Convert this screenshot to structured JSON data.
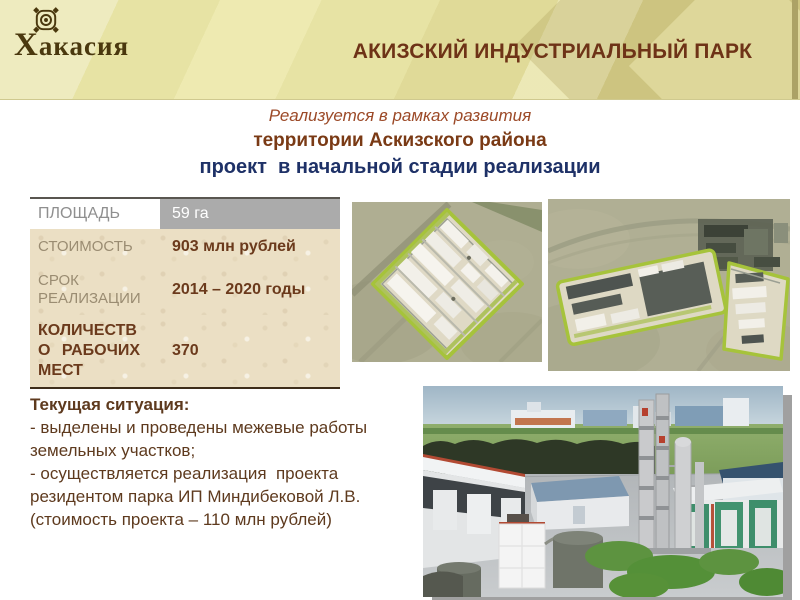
{
  "logo": {
    "region_name": "Хакасия"
  },
  "header": {
    "title": "АКИЗСКИЙ ИНДУСТРИАЛЬНЫЙ ПАРК"
  },
  "subtitle": {
    "line1": "Реализуется в рамках развития",
    "line2": "территории Аскизского района",
    "line3": "проект  в начальной стадии реализации"
  },
  "metrics_table": {
    "rows": [
      {
        "label": "ПЛОЩАДЬ",
        "value": "59 га"
      },
      {
        "label": "СТОИМОСТЬ",
        "value": "903 млн рублей"
      },
      {
        "label": "СРОК РЕАЛИЗАЦИИ",
        "value": "2014 – 2020 годы"
      },
      {
        "label": "КОЛИЧЕСТВО РАБОЧИХ МЕСТ",
        "value": "370"
      }
    ]
  },
  "situation": {
    "title": "Текущая ситуация:",
    "items": [
      "- выделены и проведены межевые работы земельных участков;",
      "- осуществляется реализация  проекта резидентом парка ИП Миндибековой Л.В. (стоимость проекта – 110 млн рублей)"
    ]
  },
  "colors": {
    "band_background": "#E7E3A4",
    "title_brown": "#6E3317",
    "subtitle_red": "#9C4A28",
    "subtitle_navy": "#1E3167",
    "table_value_brown": "#6B3A1C",
    "table_header_gray": "#ABABAB",
    "parchment": "#EBDFC4",
    "park_border_green": "#A6C33B"
  }
}
